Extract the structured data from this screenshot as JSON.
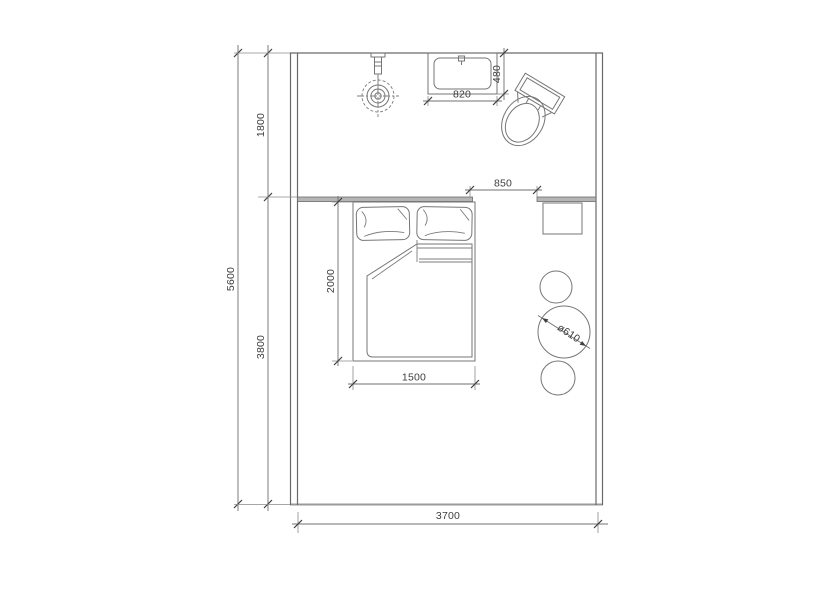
{
  "drawing": {
    "kind": "bedroom-with-bath floor plan",
    "colors": {
      "background": "#ffffff",
      "wall_line": "#6a6a6a",
      "furniture_line": "#767676",
      "dimension_line": "#707070",
      "partition_fill": "#b5b5b5",
      "text": "#3d3d3d"
    },
    "dimensions": {
      "total_depth": "5600",
      "bath_zone_depth": "1800",
      "bedroom_zone_depth": "3800",
      "room_width": "3700",
      "basin_width": "820",
      "basin_depth": "480",
      "opening_width": "850",
      "bed_length": "2000",
      "bed_width": "1500",
      "table_diameter": "ø610"
    },
    "furniture": {
      "shower": "ceiling shower with drain",
      "basin": "wash basin",
      "toilet": "toilet (rotated)",
      "bed": "double bed with pillows and duvet",
      "side_table": "square side table",
      "stool_top": "round stool",
      "round_table": "round table ø610",
      "stool_bottom": "round stool"
    }
  }
}
